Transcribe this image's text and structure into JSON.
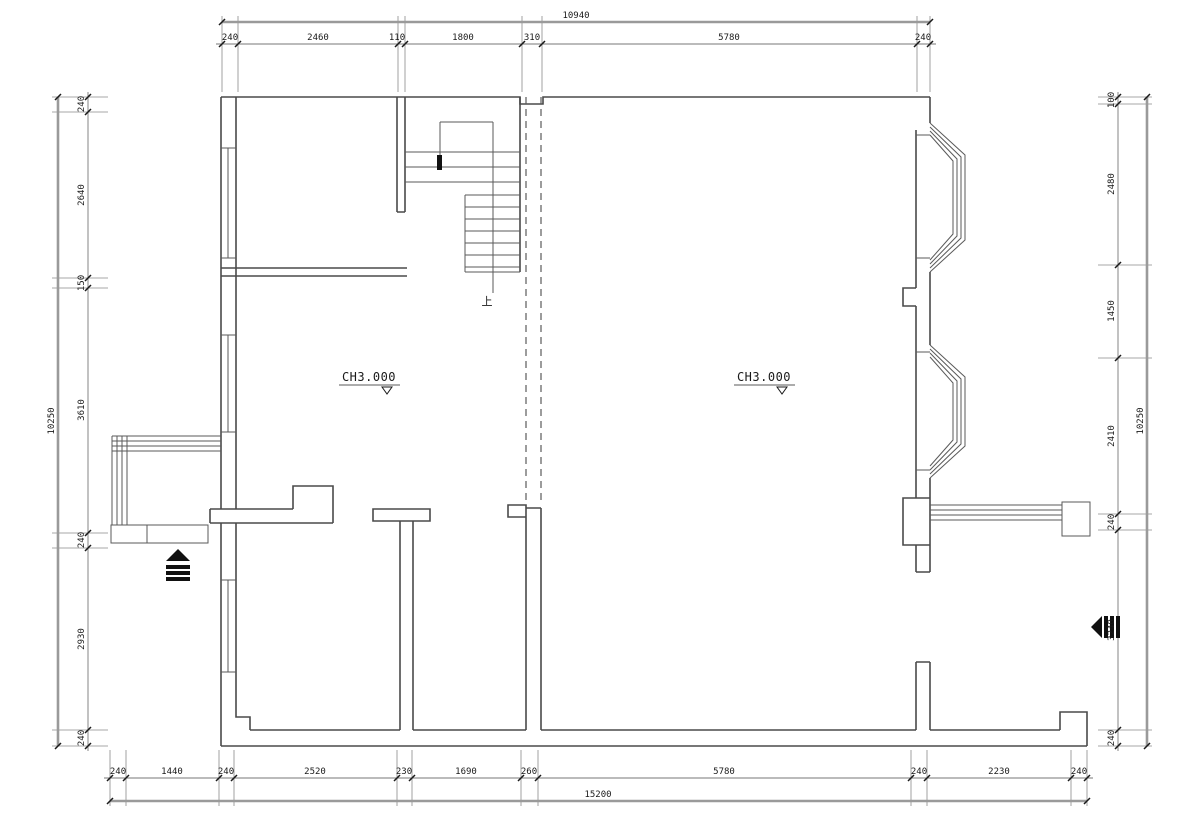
{
  "drawing_title": "floor-plan",
  "colors": {
    "background": "#ffffff",
    "wall_line": "#4a4a4a",
    "thin_line": "#5a5a5a",
    "dim_line": "#777777",
    "total_dim_line": "#9a9a9a",
    "text": "#1a1a1a"
  },
  "labels": {
    "left_room_height": "CH3.000",
    "right_room_height": "CH3.000",
    "stair_up": "上"
  },
  "dims": {
    "top": {
      "total": "10940",
      "segments": [
        "240",
        "2460",
        "110",
        "1800",
        "310",
        "5780",
        "240"
      ]
    },
    "bottom": {
      "total": "15200",
      "segments": [
        "240",
        "1440",
        "240",
        "2520",
        "230",
        "1690",
        "260",
        "5780",
        "240",
        "2230",
        "240"
      ]
    },
    "left": {
      "total": "10250",
      "segments": [
        "240",
        "2640",
        "150",
        "3610",
        "240",
        "2930",
        "240"
      ]
    },
    "right": {
      "total": "10250",
      "segments": [
        "100",
        "2480",
        "1450",
        "2410",
        "240",
        "3240",
        "240"
      ]
    }
  }
}
